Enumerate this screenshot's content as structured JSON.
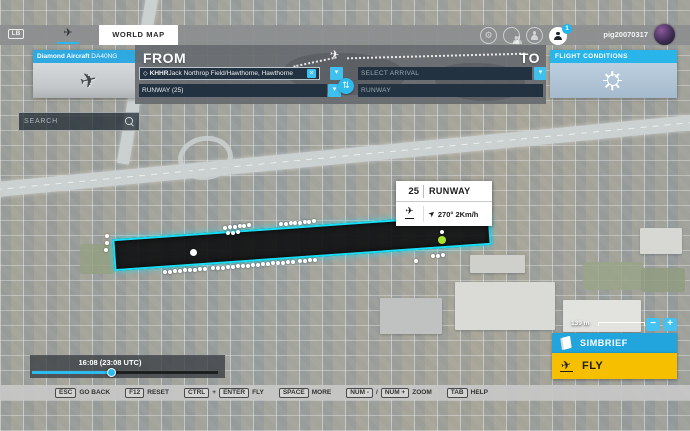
{
  "topbar": {
    "lb_badge": "LB",
    "tab_label": "WORLD MAP",
    "username": "pig20070317",
    "notification_count": "1"
  },
  "aircraft_panel": {
    "maker_bold": "Diamond Aircraft",
    "model": " DA40NG"
  },
  "search": {
    "placeholder": "SEARCH"
  },
  "flight_planner": {
    "from_label": "FROM",
    "to_label": "TO",
    "departure_code": "KHHR",
    "departure_name": " Jack Northrop Field/Hawthorne, Hawthorne",
    "departure_runway": "RUNWAY (25)",
    "arrival_placeholder": "SELECT ARRIVAL",
    "arrival_runway_placeholder": "RUNWAY"
  },
  "flight_conditions": {
    "title": "FLIGHT CONDITIONS"
  },
  "runway_tooltip": {
    "number": "25",
    "label": "RUNWAY",
    "wind": "270° 2Km/h"
  },
  "time_slider": {
    "label": "16:08 (23:08 UTC)"
  },
  "map_controls": {
    "scale_label": "139 m",
    "zoom_out": "−",
    "zoom_in": "+"
  },
  "actions": {
    "simbrief": "SIMBRIEF",
    "fly": "FLY"
  },
  "help_bar": {
    "items": [
      {
        "key": "ESC",
        "label": "GO BACK"
      },
      {
        "key": "F12",
        "label": "RESET"
      },
      {
        "key": "CTRL",
        "joiner": "+",
        "key2": "ENTER",
        "label": "FLY"
      },
      {
        "key": "SPACE",
        "label": "MORE"
      },
      {
        "key": "NUM -",
        "joiner": "/",
        "key2": "NUM +",
        "label": "ZOOM"
      },
      {
        "key": "TAB",
        "label": "HELP"
      }
    ]
  },
  "icons": {
    "home": "✈",
    "gear": "⚙",
    "waypoint_diamond": "◇",
    "clear": "×",
    "chevron_down": "▾",
    "swap": "⇅",
    "plane": "✈",
    "wind_arrow": "➤"
  },
  "colors": {
    "accent_cyan": "#2fbaee",
    "runway_outline": "#17dff8",
    "fly_yellow": "#f6c000",
    "selected_spawn_green": "#a8e22e"
  },
  "map_markers": {
    "dots": [
      {
        "x": 107,
        "y": 236
      },
      {
        "x": 107,
        "y": 243
      },
      {
        "x": 106,
        "y": 250
      },
      {
        "x": 193,
        "y": 252,
        "r": 3.5
      },
      {
        "x": 225,
        "y": 228
      },
      {
        "x": 230,
        "y": 227
      },
      {
        "x": 235,
        "y": 227
      },
      {
        "x": 240,
        "y": 226
      },
      {
        "x": 244,
        "y": 226
      },
      {
        "x": 249,
        "y": 225
      },
      {
        "x": 228,
        "y": 233
      },
      {
        "x": 233,
        "y": 233
      },
      {
        "x": 238,
        "y": 232
      },
      {
        "x": 281,
        "y": 224
      },
      {
        "x": 286,
        "y": 224
      },
      {
        "x": 291,
        "y": 223
      },
      {
        "x": 295,
        "y": 223
      },
      {
        "x": 300,
        "y": 223
      },
      {
        "x": 305,
        "y": 222
      },
      {
        "x": 309,
        "y": 222
      },
      {
        "x": 314,
        "y": 221
      },
      {
        "x": 165,
        "y": 272
      },
      {
        "x": 170,
        "y": 272
      },
      {
        "x": 175,
        "y": 271
      },
      {
        "x": 180,
        "y": 271
      },
      {
        "x": 185,
        "y": 270
      },
      {
        "x": 190,
        "y": 270
      },
      {
        "x": 195,
        "y": 270
      },
      {
        "x": 200,
        "y": 269
      },
      {
        "x": 205,
        "y": 269
      },
      {
        "x": 213,
        "y": 268
      },
      {
        "x": 218,
        "y": 268
      },
      {
        "x": 223,
        "y": 268
      },
      {
        "x": 228,
        "y": 267
      },
      {
        "x": 233,
        "y": 267
      },
      {
        "x": 238,
        "y": 266
      },
      {
        "x": 243,
        "y": 266
      },
      {
        "x": 248,
        "y": 266
      },
      {
        "x": 253,
        "y": 265
      },
      {
        "x": 258,
        "y": 265
      },
      {
        "x": 263,
        "y": 264
      },
      {
        "x": 268,
        "y": 264
      },
      {
        "x": 273,
        "y": 263
      },
      {
        "x": 278,
        "y": 263
      },
      {
        "x": 283,
        "y": 263
      },
      {
        "x": 288,
        "y": 262
      },
      {
        "x": 293,
        "y": 262
      },
      {
        "x": 300,
        "y": 261
      },
      {
        "x": 305,
        "y": 261
      },
      {
        "x": 310,
        "y": 260
      },
      {
        "x": 315,
        "y": 260
      },
      {
        "x": 416,
        "y": 261
      },
      {
        "x": 433,
        "y": 256
      },
      {
        "x": 438,
        "y": 256
      },
      {
        "x": 443,
        "y": 255
      },
      {
        "x": 442,
        "y": 232
      },
      {
        "x": 442,
        "y": 240,
        "r": 4,
        "c": "#a8e22e"
      }
    ]
  }
}
